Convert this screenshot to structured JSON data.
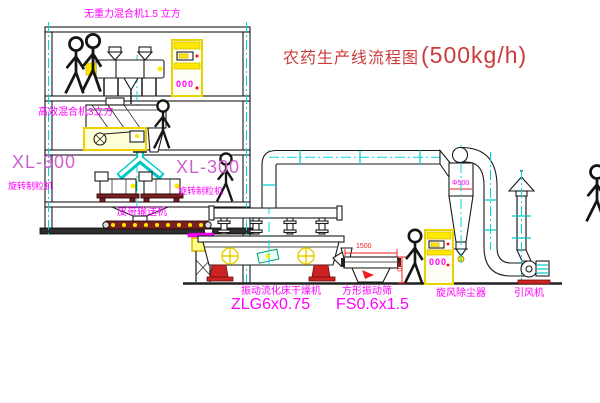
{
  "title": {
    "zh": "农药生产线流程图",
    "capacity": "(500kg/h)"
  },
  "labels": {
    "gravity_mixer": "无重力混合机1.5 立方",
    "high_mixer": "高效混合机3立方",
    "granulator_model": "XL-300",
    "granulator_name": "旋转制粒机",
    "belt_conveyor": "皮带输送机",
    "dryer_name": "振动流化床干燥机",
    "dryer_model": "ZLG6x0.75",
    "screen_name": "方形振动筛",
    "screen_model": "FS0.6x1.5",
    "cyclone_name": "旋风除尘器",
    "fan_name": "引风机"
  },
  "dimensions": {
    "cyclone_diameter": "Φ500",
    "screen_length": "1500",
    "screen_height": "540"
  },
  "cabinet_display": "000",
  "colors": {
    "magenta": "#ff00ff",
    "orchid": "#cf5fd0",
    "title_red": "#cc3b3b",
    "dim_red": "#f02020",
    "yellow": "#ffe800",
    "cyan": "#00c8c8",
    "centerline_cyan": "#00d8d8",
    "belt_maroon": "#7a2020",
    "machine_red": "#cc2222"
  }
}
